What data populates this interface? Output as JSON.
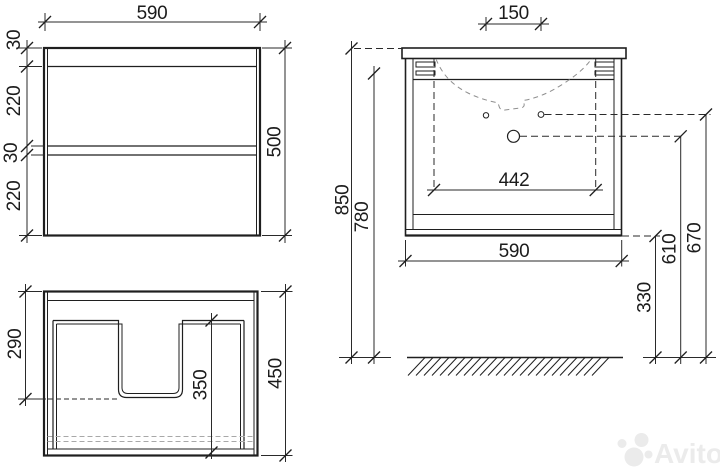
{
  "drawing": {
    "front": {
      "width": "590",
      "height": "500",
      "chain": [
        "30",
        "220",
        "30",
        "220"
      ]
    },
    "top": {
      "cutout_depth": "290",
      "depth": "450",
      "drawer_depth": "350"
    },
    "side": {
      "faucet_spacing": "150",
      "sink_width": "442",
      "width": "590",
      "total_height": "850",
      "underside_height": "780",
      "floor_clearance": "330",
      "drain_height": "610",
      "faucet_height": "670"
    },
    "colors": {
      "line": "#1f1f1f",
      "hidden_line": "#8f8f8f",
      "background": "#ffffff",
      "watermark": "#ebebeb"
    }
  },
  "watermark": {
    "brand": "Avito"
  }
}
